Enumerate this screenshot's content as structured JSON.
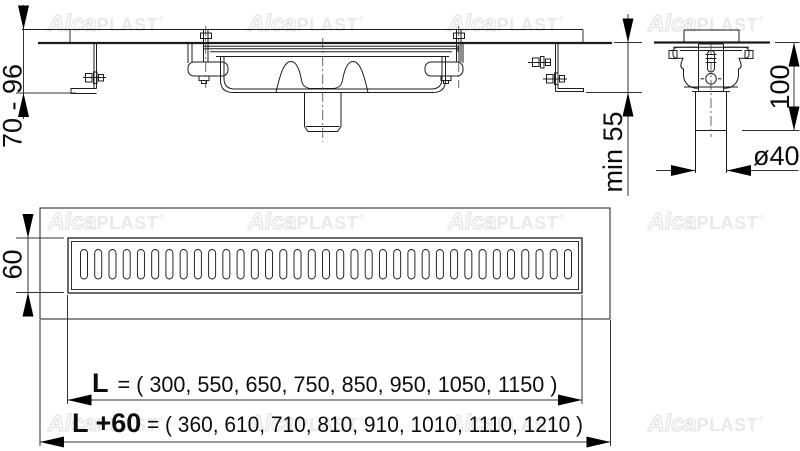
{
  "brand": {
    "alca": "Alca",
    "plast": "PLAST",
    "registered": "®"
  },
  "dimensions": {
    "installation_height_range": "70 - 96",
    "min_floor_depth": "min 55",
    "trap_outlet_height": "100",
    "outlet_pipe_diameter": "ø40",
    "grate_width": "60",
    "channel_length": {
      "label": "L",
      "values": "= ( 300, 550, 650, 750, 850, 950, 1050, 1150 )"
    },
    "overall_length": {
      "label": "L +60",
      "values": "= ( 360, 610, 710, 810, 910, 1010, 1110, 1210 )"
    }
  },
  "colors": {
    "line": "#1c1c1c",
    "dimension": "#333333",
    "arrow": "#000000",
    "watermark": "#e9e9e9",
    "background": "#ffffff"
  }
}
